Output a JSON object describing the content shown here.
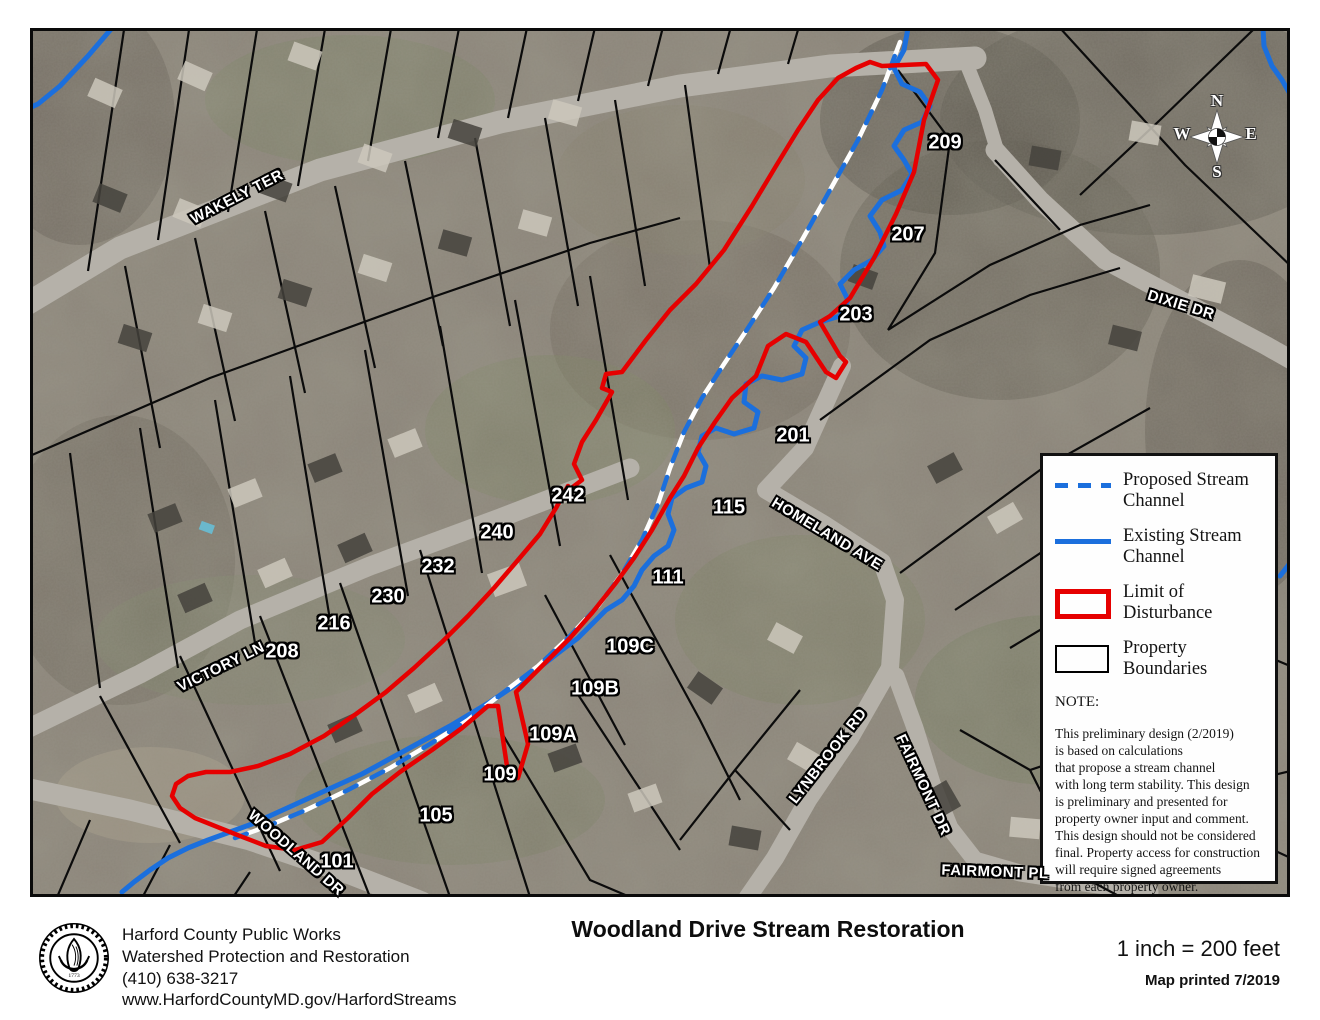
{
  "map": {
    "colors": {
      "proposed_stream": "#1b6fdd",
      "existing_stream": "#1b6fdd",
      "limit_of_disturbance": "#e60000",
      "property_boundary": "#000000",
      "road": "#b5b1a9"
    },
    "streets": [
      {
        "text": "WAKELY TER",
        "x": 237,
        "y": 197,
        "rot": -27
      },
      {
        "text": "DIXIE DR",
        "x": 1181,
        "y": 305,
        "rot": 17
      },
      {
        "text": "VICTORY LN",
        "x": 221,
        "y": 667,
        "rot": -26
      },
      {
        "text": "HOMELAND AVE",
        "x": 827,
        "y": 534,
        "rot": 31
      },
      {
        "text": "LYNBROOK RD",
        "x": 828,
        "y": 756,
        "rot": -52
      },
      {
        "text": "FAIRMONT DR",
        "x": 923,
        "y": 785,
        "rot": 65
      },
      {
        "text": "FAIRMONT PL",
        "x": 995,
        "y": 872,
        "rot": 2
      },
      {
        "text": "WOODLAND DR",
        "x": 296,
        "y": 853,
        "rot": 41
      }
    ],
    "parcels": [
      {
        "text": "209",
        "x": 945,
        "y": 143
      },
      {
        "text": "207",
        "x": 908,
        "y": 235
      },
      {
        "text": "203",
        "x": 856,
        "y": 315
      },
      {
        "text": "201",
        "x": 793,
        "y": 436
      },
      {
        "text": "242",
        "x": 568,
        "y": 496
      },
      {
        "text": "240",
        "x": 497,
        "y": 533
      },
      {
        "text": "232",
        "x": 438,
        "y": 567
      },
      {
        "text": "230",
        "x": 388,
        "y": 597
      },
      {
        "text": "216",
        "x": 334,
        "y": 624
      },
      {
        "text": "208",
        "x": 282,
        "y": 652
      },
      {
        "text": "115",
        "x": 729,
        "y": 508
      },
      {
        "text": "111",
        "x": 668,
        "y": 578
      },
      {
        "text": "109C",
        "x": 630,
        "y": 647
      },
      {
        "text": "109B",
        "x": 595,
        "y": 689
      },
      {
        "text": "109A",
        "x": 553,
        "y": 735
      },
      {
        "text": "109",
        "x": 500,
        "y": 775
      },
      {
        "text": "105",
        "x": 436,
        "y": 816
      },
      {
        "text": "101",
        "x": 337,
        "y": 862
      }
    ],
    "compass": {
      "n": "N",
      "e": "E",
      "s": "S",
      "w": "W"
    }
  },
  "legend": {
    "items": [
      {
        "label": "Proposed Stream\nChannel"
      },
      {
        "label": "Existing Stream\nChannel"
      },
      {
        "label": "Limit of\nDisturbance"
      },
      {
        "label": "Property\nBoundaries"
      }
    ],
    "note_heading": "NOTE:",
    "note_text": "This preliminary design (2/2019)\nis based on calculations\nthat propose a stream channel\nwith long term stability. This design\nis preliminary and presented for\nproperty owner input and comment.\nThis design should not be considered\nfinal. Property access for construction\nwill require signed agreements\nfrom each property owner."
  },
  "footer": {
    "agency_info": "Harford County Public Works\nWatershed Protection and Restoration\n(410) 638-3217\nwww.HarfordCountyMD.gov/HarfordStreams",
    "title": "Woodland Drive Stream Restoration",
    "scale": "1 inch = 200 feet",
    "printed": "Map printed 7/2019"
  }
}
